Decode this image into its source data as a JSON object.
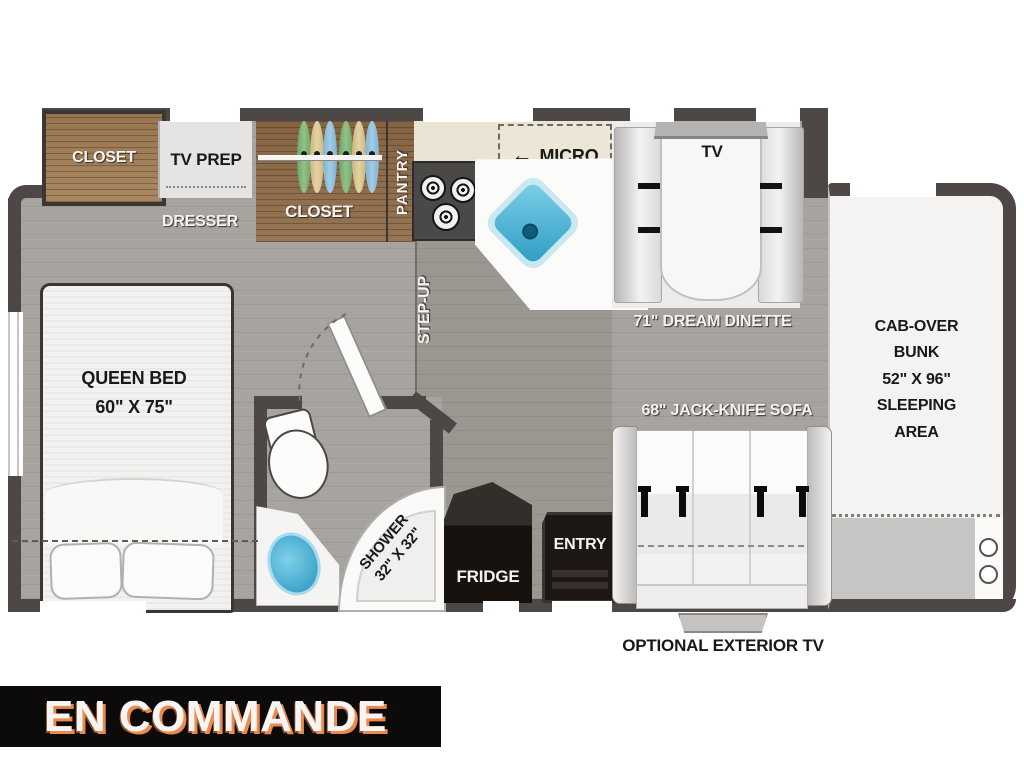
{
  "colors": {
    "wall": "#4d4845",
    "floor": "#a7a39e",
    "wood": "#8e6b47",
    "sink_blue": "#3aa7cd",
    "banner_bg": "#0c0b0a",
    "banner_text": "#f7f5f3",
    "banner_shadow": "#ec8a4e"
  },
  "labels": {
    "closet_bedroom": "CLOSET",
    "tv_prep": "TV PREP",
    "dresser": "DRESSER",
    "closet_wardrobe": "CLOSET",
    "pantry": "PANTRY",
    "micro_arrow": "←",
    "micro": "MICRO",
    "step_up": "STEP-UP",
    "tv": "TV",
    "dinette": "71\" DREAM DINETTE",
    "sofa": "68\" JACK-KNIFE SOFA",
    "queen_bed": [
      "QUEEN BED",
      "60\" X 75\""
    ],
    "shower": [
      "SHOWER",
      "32\" X 32\""
    ],
    "fridge": "FRIDGE",
    "entry": "ENTRY",
    "cab_over_bunk": [
      "CAB-OVER",
      "BUNK",
      "52\" X 96\"",
      "SLEEPING",
      "AREA"
    ],
    "optional_exterior_tv": "OPTIONAL EXTERIOR TV"
  },
  "banner": {
    "text": "EN COMMANDE"
  }
}
